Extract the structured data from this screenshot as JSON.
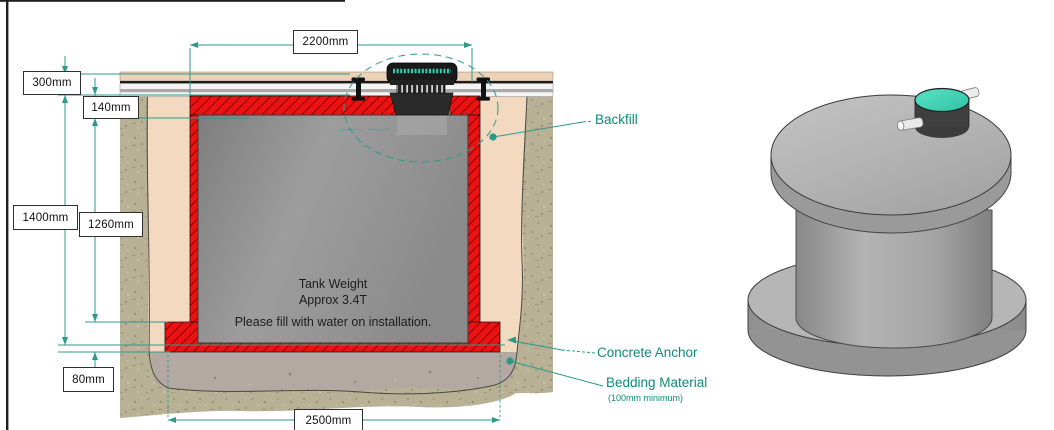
{
  "diagram": {
    "dimension_labels": {
      "width_top": "2200mm",
      "depth_cover": "300mm",
      "depth_lid": "140mm",
      "depth_overall": "1400mm",
      "depth_tank": "1260mm",
      "depth_base": "80mm",
      "width_base": "2500mm"
    },
    "callouts": {
      "backfill": "Backfill",
      "concrete_anchor": "Concrete Anchor",
      "bedding_material": "Bedding Material",
      "bedding_note": "(100mm minimum)"
    },
    "tank_text": {
      "weight_line1": "Tank Weight",
      "weight_line2": "Approx 3.4T",
      "fill_note": "Please fill with water on installation."
    }
  },
  "colors": {
    "annotation_teal": "#1d9384",
    "callout_text_teal": "#0f8a7a",
    "concrete_red": "#ec1212",
    "hatch_dark_red": "#8a0000",
    "backfill_tan": "#f3d9c0",
    "soil_khaki": "#b8b195",
    "bedding_grey": "#b3a8a2",
    "tank_grey": "#9c9c9c",
    "lid_teal": "#3fd6b7"
  }
}
